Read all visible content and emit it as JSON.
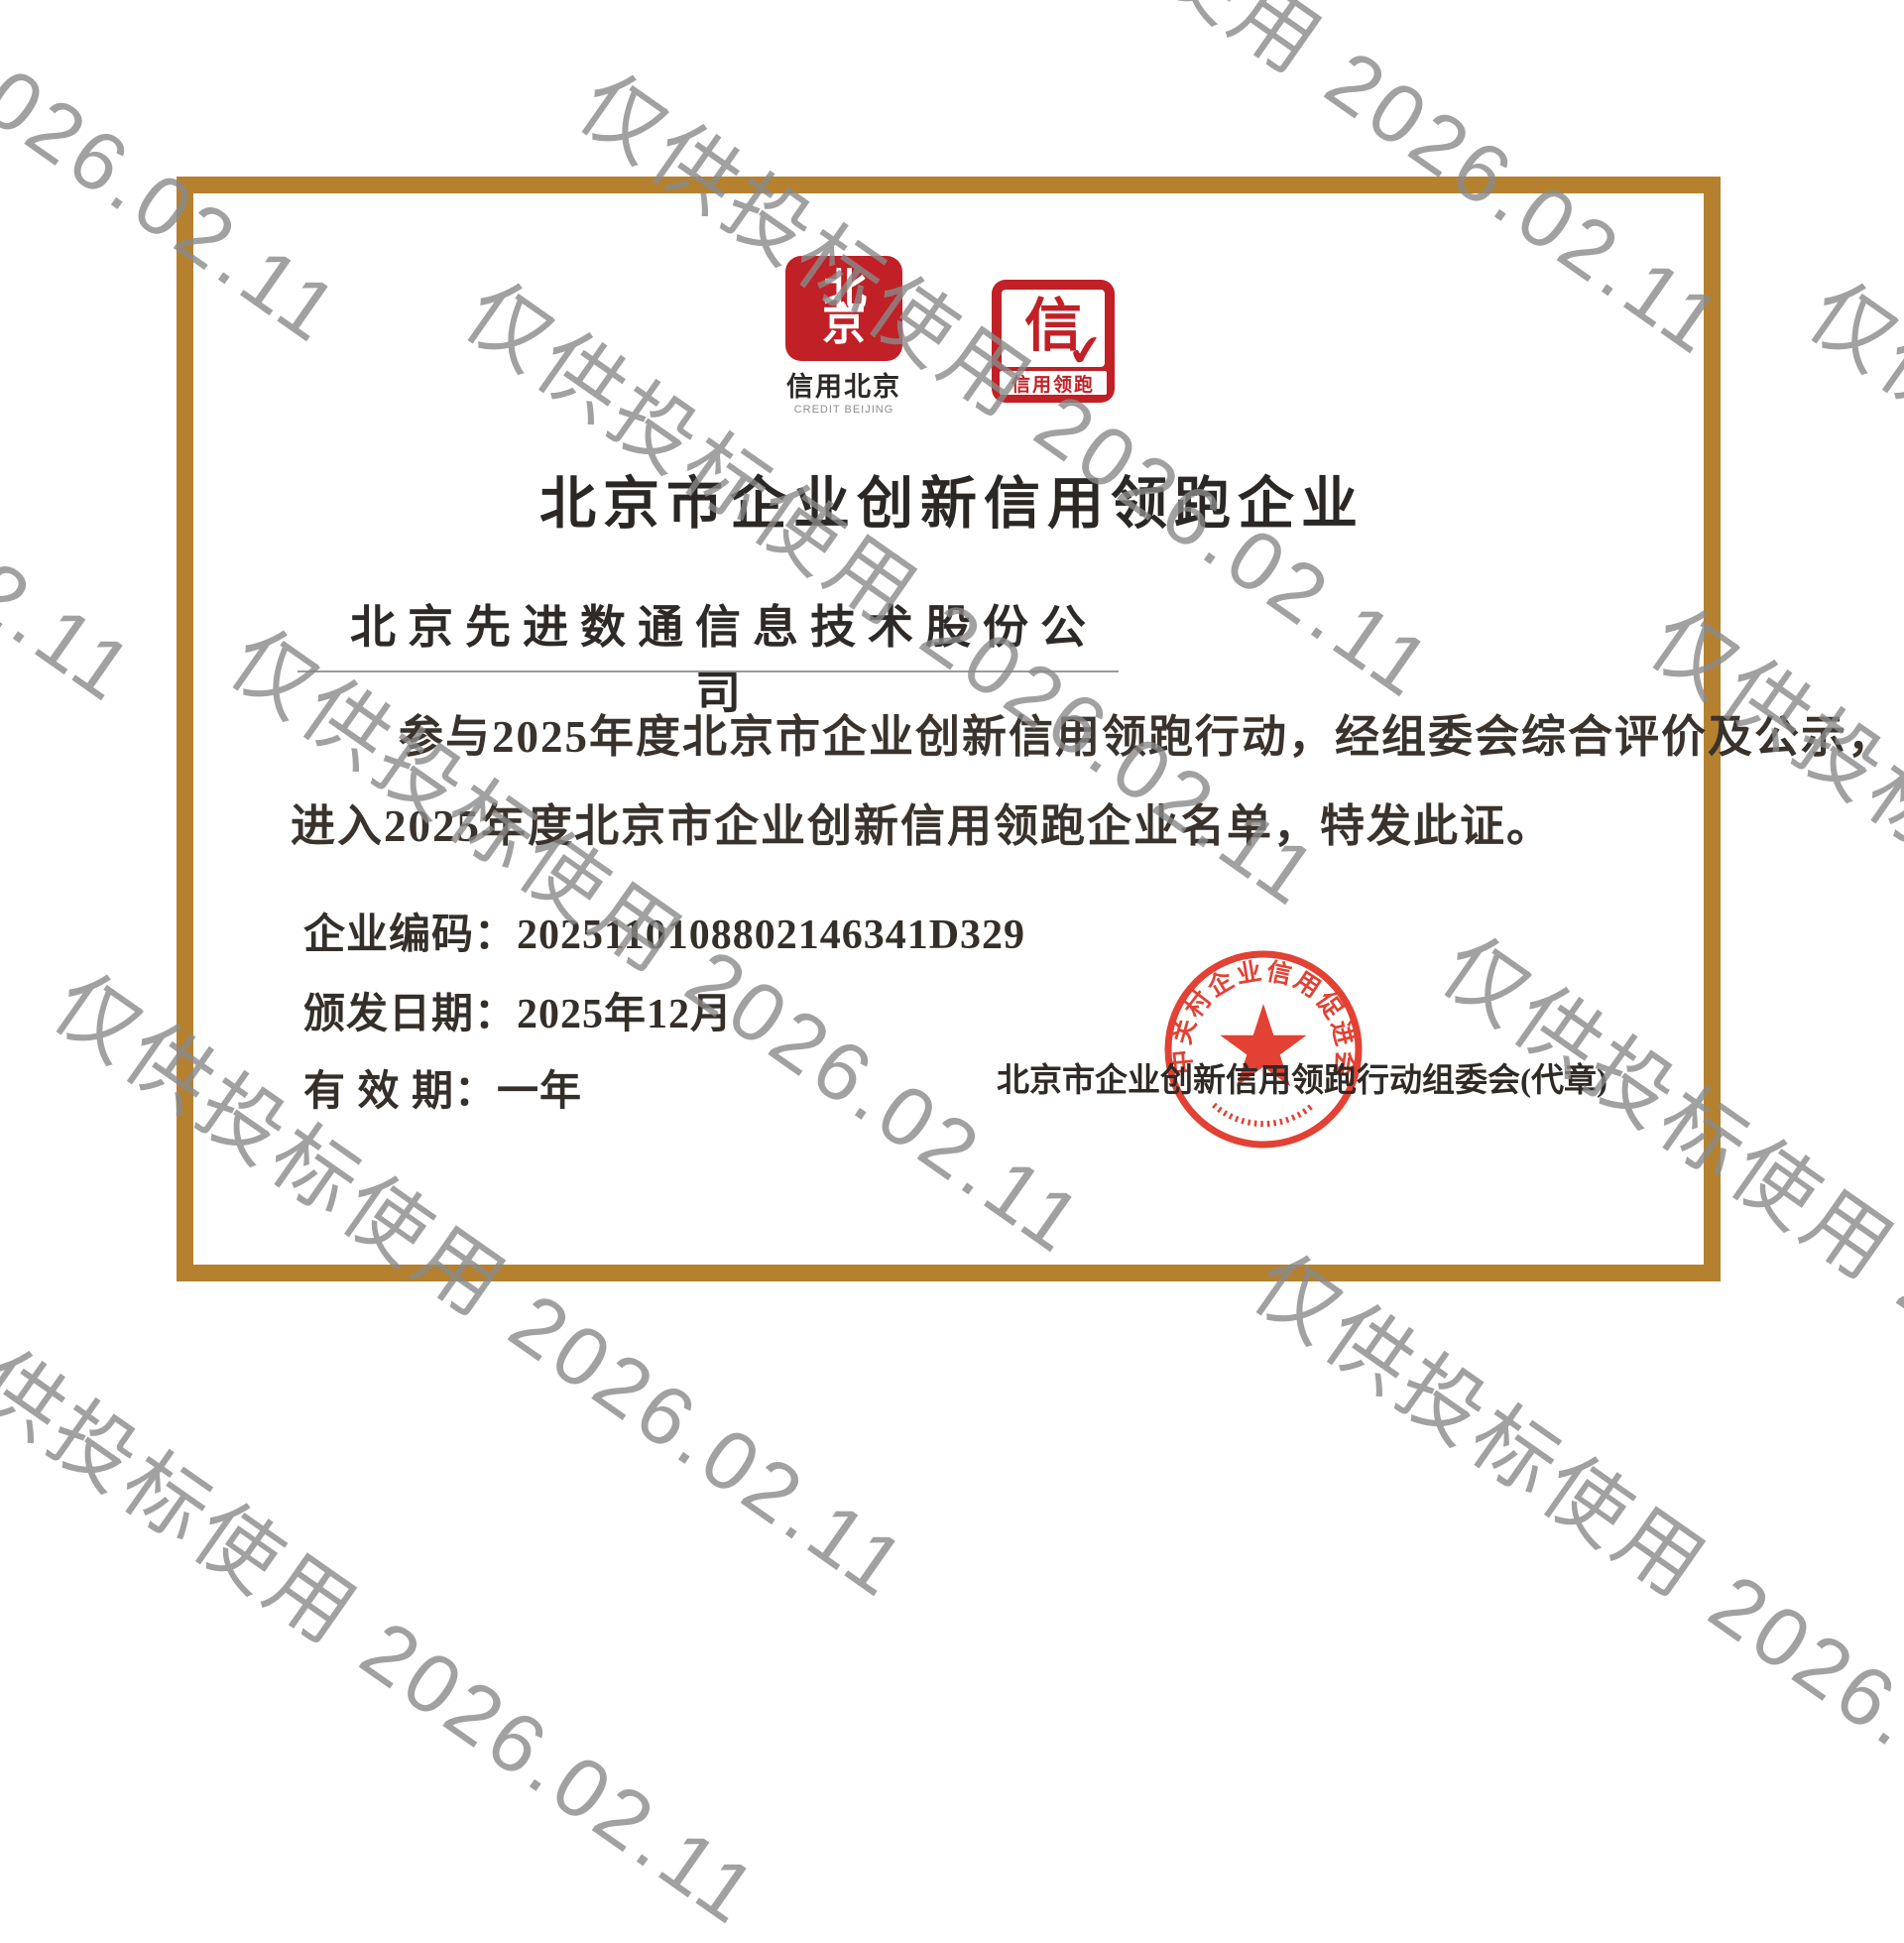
{
  "watermark": {
    "text": "仅供投标使用 2026.02.11",
    "color": "#8a8a8a"
  },
  "logos": {
    "credit_beijing": {
      "emblem_top": "北",
      "emblem_bottom": "京",
      "caption_cn": "信用北京",
      "caption_en": "CREDIT BEIJING"
    },
    "credit_leader": {
      "glyph": "信",
      "check": "✔",
      "band_text": "信用领跑"
    }
  },
  "certificate": {
    "title": "北京市企业创新信用领跑企业",
    "company_name": "北京先进数通信息技术股份公司",
    "body_line1": "参与2025年度北京市企业创新信用领跑行动，经组委会综合评价及公示，",
    "body_line2": "进入2025年度北京市企业创新信用领跑企业名单，特发此证。",
    "fields": [
      {
        "label": "企业编码：",
        "value": "2025110108802146341D329"
      },
      {
        "label": "颁发日期：",
        "value": "2025年12月"
      },
      {
        "label": "有 效 期：",
        "value": "一年"
      }
    ],
    "issuer": "北京市企业创新信用领跑行动组委会(代章)"
  },
  "seal": {
    "ring_text": "中关村企业信用促进会",
    "color": "#e03325"
  },
  "colors": {
    "border_gold": "#b5812f",
    "logo_red": "#c12026",
    "ink": "#36302b"
  }
}
